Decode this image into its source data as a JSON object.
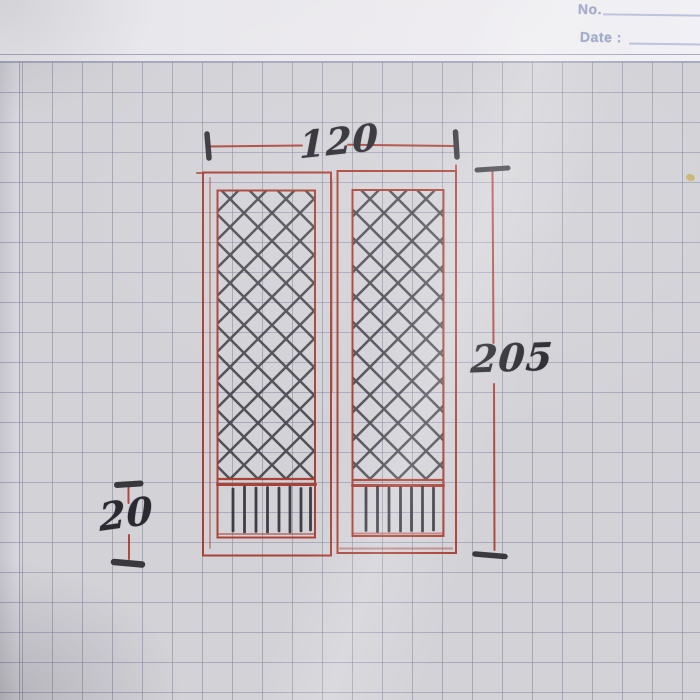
{
  "header": {
    "no_label": "No.",
    "date_label": "Date :"
  },
  "sketch": {
    "subject": "double-door elevation, hand-drawn on graph paper",
    "dim_width": "120",
    "dim_height": "205",
    "dim_bottom_panel": "20"
  },
  "colors": {
    "pen_red": "#a93b2f",
    "pencil_black": "#2b2b31",
    "grid_line": "#686e92",
    "paper": "#d3d2d7",
    "top_margin_paper": "#eceaee",
    "printed_header_text": "#99a1c3",
    "speck_yellow": "#c9b169"
  }
}
